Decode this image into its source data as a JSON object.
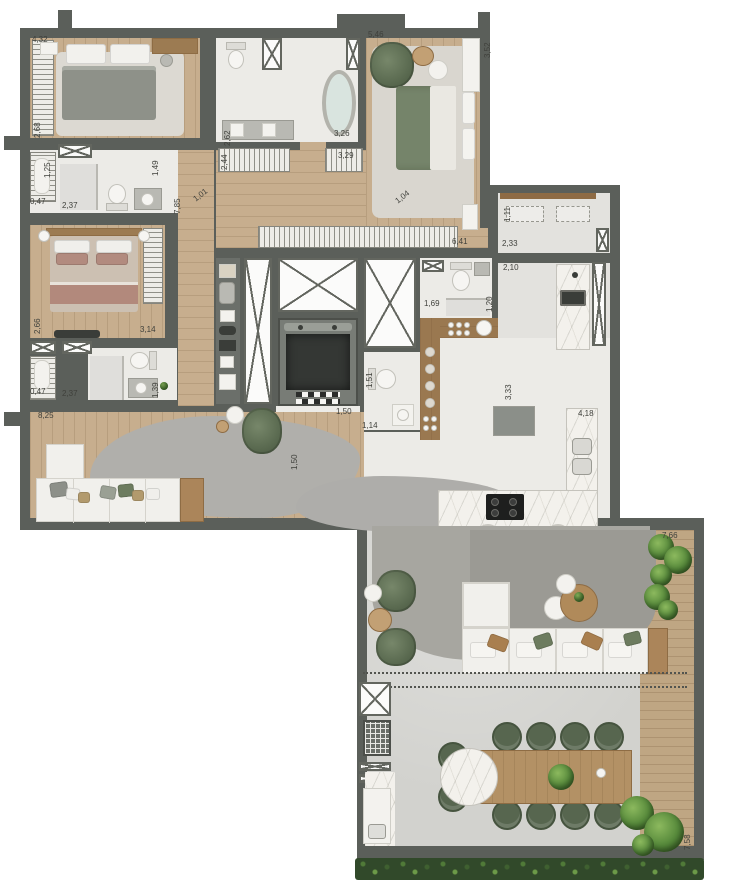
{
  "plan_title": "apartment-floor-plan",
  "colors": {
    "wall": "#5b5f5a",
    "wood_floor": "#c7ae8e",
    "white_floor": "#ecebe7",
    "terrace_floor": "#d2d2ce",
    "rug_gray": "#a9a8a2",
    "marble": "#f3f1ec",
    "accent_green": "#6d7c5f",
    "plant_green": "#55883a",
    "planter_green": "#31492a",
    "deck_wood": "#bfa683"
  },
  "dimension_labels": [
    {
      "value": "4,32",
      "x": 32,
      "y": 36,
      "rot": 0
    },
    {
      "value": "2,68",
      "x": 34,
      "y": 138,
      "rot": -90
    },
    {
      "value": "1,25",
      "x": 44,
      "y": 178,
      "rot": -90
    },
    {
      "value": "0,47",
      "x": 30,
      "y": 198,
      "rot": 0
    },
    {
      "value": "2,37",
      "x": 62,
      "y": 202,
      "rot": 0
    },
    {
      "value": "1,49",
      "x": 152,
      "y": 176,
      "rot": -90
    },
    {
      "value": "2,62",
      "x": 224,
      "y": 146,
      "rot": -90
    },
    {
      "value": "3,26",
      "x": 334,
      "y": 130,
      "rot": 0
    },
    {
      "value": "2,44",
      "x": 221,
      "y": 170,
      "rot": -90
    },
    {
      "value": "3,29",
      "x": 338,
      "y": 152,
      "rot": 0
    },
    {
      "value": "5,46",
      "x": 368,
      "y": 31,
      "rot": 0
    },
    {
      "value": "3,52",
      "x": 484,
      "y": 58,
      "rot": -90
    },
    {
      "value": "6,41",
      "x": 452,
      "y": 238,
      "rot": 0
    },
    {
      "value": "7,85",
      "x": 174,
      "y": 214,
      "rot": -90
    },
    {
      "value": "1,01",
      "x": 192,
      "y": 197,
      "rot": -38
    },
    {
      "value": "1,04",
      "x": 394,
      "y": 199,
      "rot": -38
    },
    {
      "value": "1,11",
      "x": 504,
      "y": 222,
      "rot": -90
    },
    {
      "value": "2,33",
      "x": 502,
      "y": 240,
      "rot": 0
    },
    {
      "value": "2,10",
      "x": 503,
      "y": 264,
      "rot": 0
    },
    {
      "value": "1,69",
      "x": 424,
      "y": 300,
      "rot": 0
    },
    {
      "value": "1,20",
      "x": 486,
      "y": 312,
      "rot": -90
    },
    {
      "value": "3,33",
      "x": 505,
      "y": 400,
      "rot": -90
    },
    {
      "value": "4,18",
      "x": 578,
      "y": 410,
      "rot": 0
    },
    {
      "value": "1,51",
      "x": 366,
      "y": 388,
      "rot": -90
    },
    {
      "value": "1,14",
      "x": 362,
      "y": 422,
      "rot": 0
    },
    {
      "value": "1,50",
      "x": 336,
      "y": 408,
      "rot": 0
    },
    {
      "value": "1,50",
      "x": 291,
      "y": 470,
      "rot": -90
    },
    {
      "value": "2,66",
      "x": 34,
      "y": 334,
      "rot": -90
    },
    {
      "value": "3,14",
      "x": 140,
      "y": 326,
      "rot": 0
    },
    {
      "value": "0,47",
      "x": 30,
      "y": 388,
      "rot": 0
    },
    {
      "value": "2,37",
      "x": 62,
      "y": 390,
      "rot": 0
    },
    {
      "value": "1,39",
      "x": 152,
      "y": 398,
      "rot": -90
    },
    {
      "value": "8,25",
      "x": 38,
      "y": 412,
      "rot": 0
    },
    {
      "value": "7,66",
      "x": 662,
      "y": 532,
      "rot": 0
    },
    {
      "value": "7,58",
      "x": 684,
      "y": 850,
      "rot": -90
    }
  ]
}
